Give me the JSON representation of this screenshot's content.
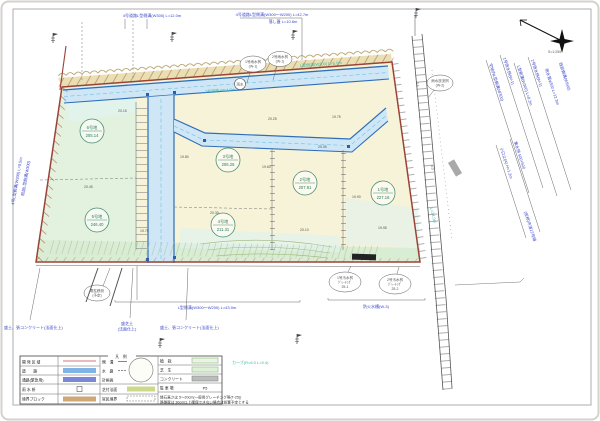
{
  "scale_label": "S=1:250",
  "colors": {
    "road_fill": "#cfe6f6",
    "road_edge": "#2f6fb8",
    "boundary": "#9a4336",
    "site_green": "#e3f2df",
    "site_cream": "#f7f3d8",
    "strip_tan": "#e8e0b2",
    "text_blue": "#3946c8",
    "text_teal": "#35b8a8",
    "plot_circle": "#4d8f72"
  },
  "top_labels": {
    "t1": "4号道路L型側溝(W300) L=12.0m",
    "t2": "4号道路L型側溝(W300〜W200) L=42.7m",
    "t2b": "落し蓋 L=10.6m"
  },
  "plots": [
    {
      "name": "6号地",
      "area": "205.14"
    },
    {
      "name": "3号地",
      "area": "206.26"
    },
    {
      "name": "2号地",
      "area": "207.91"
    },
    {
      "name": "1号地",
      "area": "227.16"
    },
    {
      "name": "5号地",
      "area": "246.40"
    },
    {
      "name": "4号地",
      "area": "211.31"
    }
  ],
  "right_labels": [
    "宅地内L型側溝(W300)",
    "1号雨水桝(W-1)",
    "L型側溝(W300) L=8.2m",
    "2号雨水桝(W-1)",
    "雨水管φ300 L=12.3m",
    "既設側溝(W500)",
    "小口止(A) H=1.2m",
    "集水桝 500×500",
    "(仮称)市道12号線"
  ],
  "left_labels": [
    "4号L型側溝(W300) L=9.5m",
    "既設L型側溝(W300)"
  ],
  "road_labels": [
    "2号道路 W=4.0m",
    "L型側溝(W300) L=5.0m",
    "L=34.0m"
  ],
  "callouts": {
    "c1": [
      "1号雨水桝",
      "(W-1)"
    ],
    "c2": [
      "2号雨水桝",
      "(W-1)"
    ],
    "c3": [
      "雨水放流桝",
      "(W-2)"
    ],
    "c4": [
      "電柱移設",
      "(予定)"
    ],
    "c5": [
      "1号汚水桝",
      "ｸﾞﾚｰﾁﾝｸﾞ",
      "25-1"
    ],
    "c6": [
      "2号汚水桝",
      "ｸﾞﾚｰﾁﾝｸﾞ",
      "25-2"
    ],
    "mh": "雨水"
  },
  "bottom_labels": {
    "b1": "盛土、張コンクリート(法面仕上)",
    "b2a": "盛芝土",
    "b2b": "(法面仕上)",
    "b3": "盛土、張コンクリート(法面仕上)",
    "b4": "L型側溝(W300〜W200) L=43.0m",
    "b5": "防火水槽(W-3)"
  },
  "legend": {
    "title": "凡　例",
    "col1": [
      {
        "label": "開 発 区 域"
      },
      {
        "label": "道　　路"
      },
      {
        "label": "通路(緊急用)"
      },
      {
        "label": "雨 水 枡"
      },
      {
        "label": "境界ブロック"
      }
    ],
    "col2": [
      {
        "label": "側　溝"
      },
      {
        "label": "水　路"
      },
      {
        "label": "計画高"
      },
      {
        "label": "芝付法面"
      },
      {
        "label": "官民境界"
      }
    ],
    "col3": [
      {
        "label": "植　栽"
      },
      {
        "label": "芝　生"
      },
      {
        "label": "コンクリート"
      },
      {
        "label": "駐 車 場",
        "value": "P5"
      }
    ],
    "notes": [
      "縁石高さは 5〜20cm(一般用グレーチング等(T-25))",
      "路盤厚は 30cm以上確保できない場合は設置予定とする"
    ],
    "side_note": "カーブ(R=6.0 L=9.4)"
  },
  "spots": [
    "20.15",
    "19.80",
    "20.30",
    "19.60",
    "20.05",
    "19.90",
    "20.45",
    "19.70",
    "20.10",
    "19.95",
    "20.25",
    "19.75"
  ],
  "corridor_labels": [
    "3.6",
    "4.0"
  ]
}
